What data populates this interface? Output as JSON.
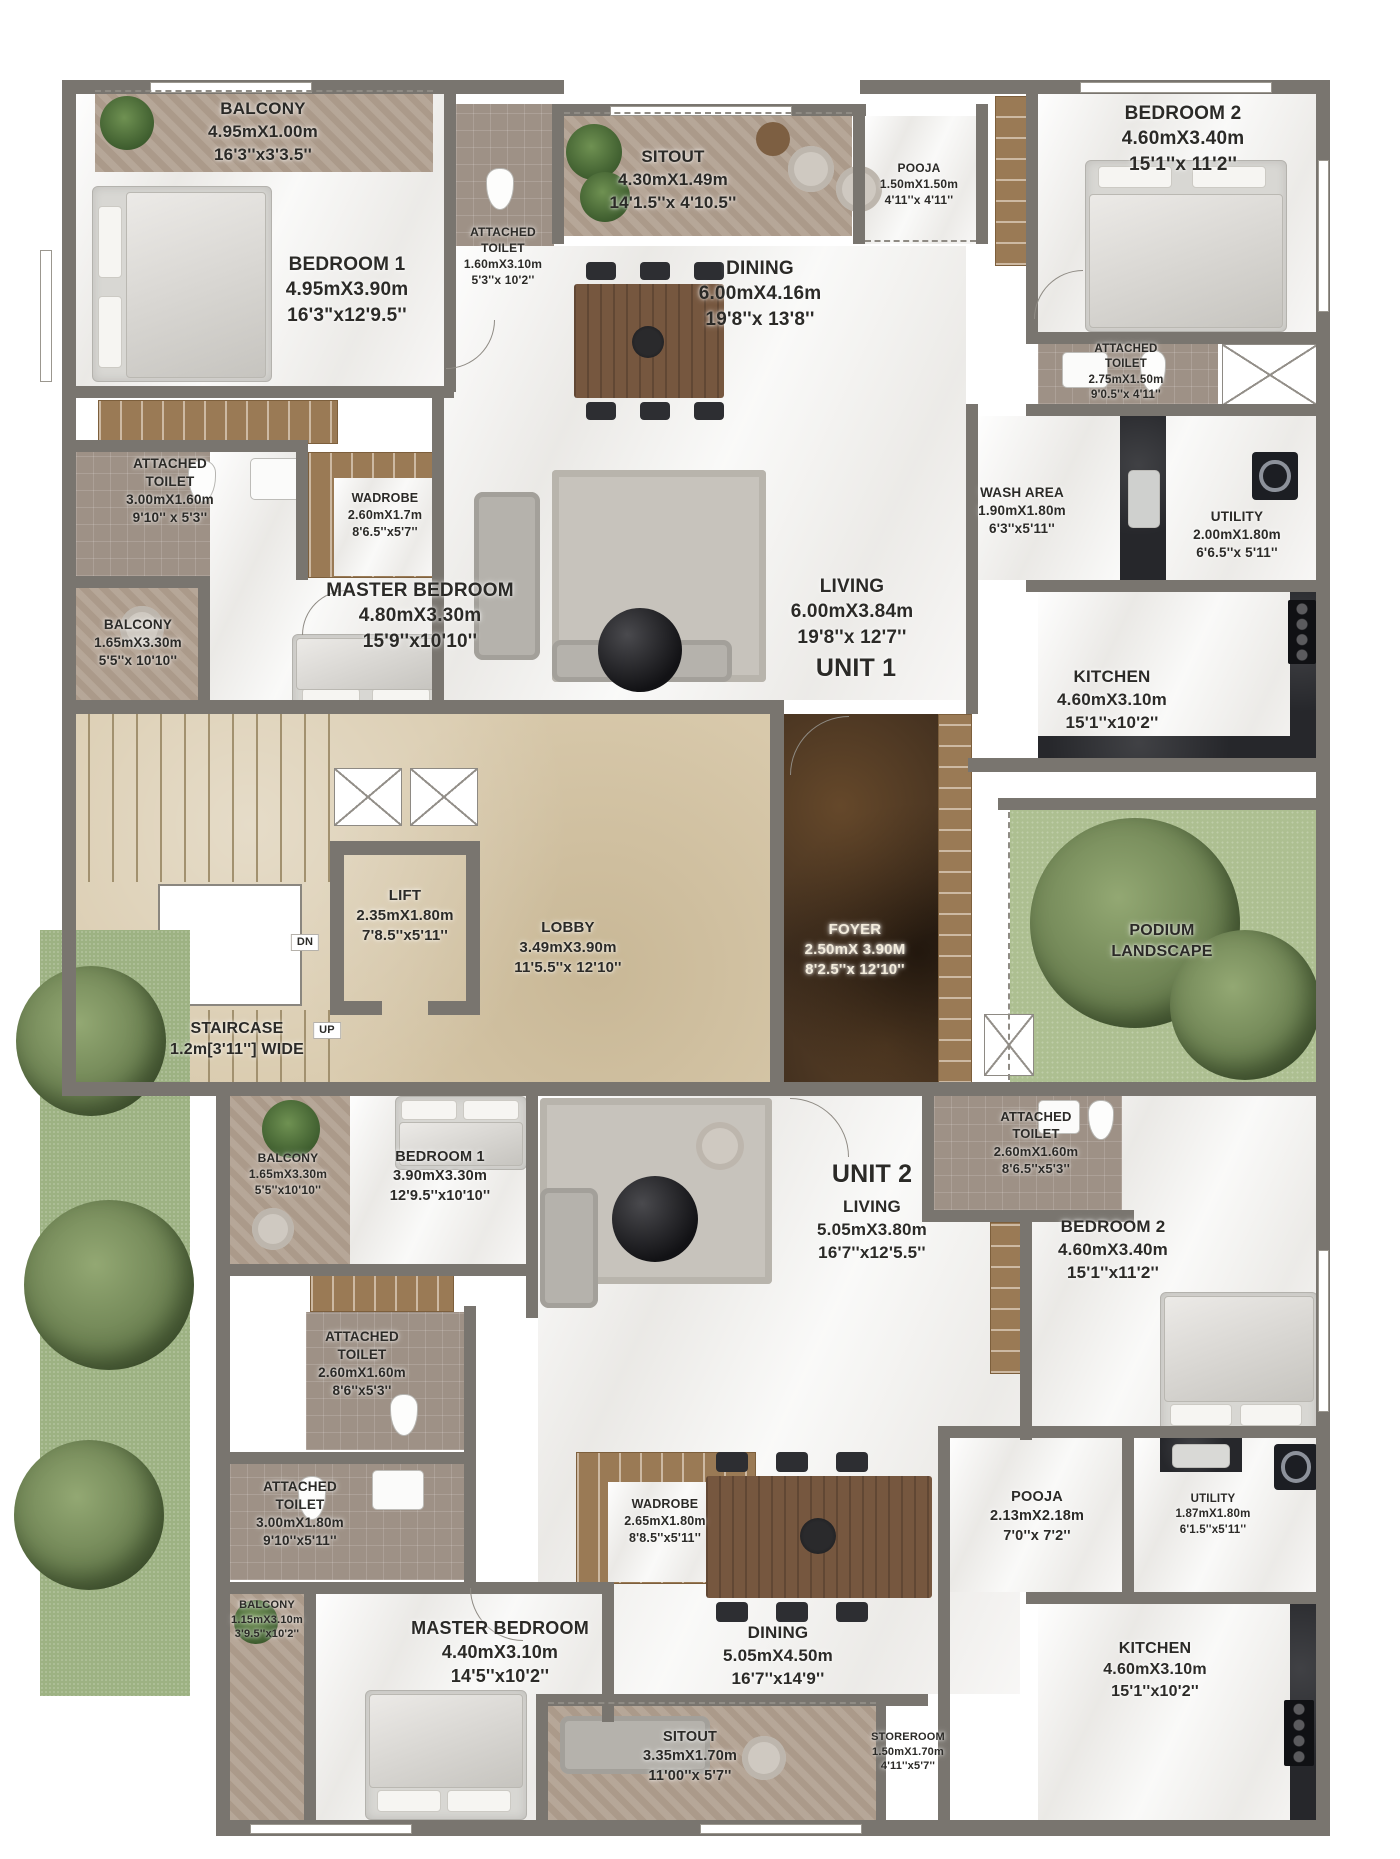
{
  "plan": {
    "type": "residential floor plan",
    "units": [
      "UNIT 1",
      "UNIT 2"
    ],
    "colors": {
      "wall": "#79756f",
      "balcony_floor": "#b1a090",
      "lobby_marble": "#d8c9ab",
      "foyer_marble": "#3e2d1e",
      "podium_green": "#adbf91",
      "wood": "#9a7a55",
      "label_text": "#2b2a27"
    }
  },
  "rooms": [
    {
      "id": "u1-balcony-1",
      "lines": [
        "BALCONY",
        "4.95mX1.00m",
        "16'3''x3'3.5''"
      ],
      "x": 263,
      "y": 98,
      "size": 17
    },
    {
      "id": "u1-bedroom-1",
      "lines": [
        "BEDROOM 1",
        "4.95mX3.90m",
        "16'3\"x12'9.5''"
      ],
      "x": 347,
      "y": 252,
      "size": 19
    },
    {
      "id": "u1-toilet-bedroom-1",
      "lines": [
        "ATTACHED",
        "TOILET",
        "1.60mX3.10m",
        "5'3''x 10'2''"
      ],
      "x": 503,
      "y": 224,
      "size": 12
    },
    {
      "id": "u1-sitout",
      "lines": [
        "SITOUT",
        "4.30mX1.49m",
        "14'1.5''x 4'10.5''"
      ],
      "x": 673,
      "y": 146,
      "size": 17
    },
    {
      "id": "u1-pooja",
      "lines": [
        "POOJA",
        "1.50mX1.50m",
        "4'11''x 4'11''"
      ],
      "x": 919,
      "y": 160,
      "size": 12
    },
    {
      "id": "u1-dining",
      "lines": [
        "DINING",
        "6.00mX4.16m",
        "19'8''x 13'8''"
      ],
      "x": 760,
      "y": 256,
      "size": 19
    },
    {
      "id": "u1-bedroom-2",
      "lines": [
        "BEDROOM 2",
        "4.60mX3.40m",
        "15'1''x 11'2''"
      ],
      "x": 1183,
      "y": 101,
      "size": 19
    },
    {
      "id": "u1-toilet-bedroom-2",
      "lines": [
        "ATTACHED",
        "TOILET",
        "2.75mX1.50m",
        "9'0.5''x 4'11''"
      ],
      "x": 1126,
      "y": 342,
      "size": 11.5
    },
    {
      "id": "u1-toilet-master",
      "lines": [
        "ATTACHED",
        "TOILET",
        "3.00mX1.60m",
        "9'10'' x 5'3''"
      ],
      "x": 170,
      "y": 455,
      "size": 13.5
    },
    {
      "id": "u1-wadrobe",
      "lines": [
        "WADROBE",
        "2.60mX1.7m",
        "8'6.5''x5'7''"
      ],
      "x": 385,
      "y": 490,
      "size": 12.5
    },
    {
      "id": "u1-master-bedroom",
      "lines": [
        "MASTER BEDROOM",
        "4.80mX3.30m",
        "15'9''x10'10''"
      ],
      "x": 420,
      "y": 578,
      "size": 19
    },
    {
      "id": "u1-balcony-2",
      "lines": [
        "BALCONY",
        "1.65mX3.30m",
        "5'5''x 10'10''"
      ],
      "x": 138,
      "y": 616,
      "size": 13.5
    },
    {
      "id": "u1-living",
      "lines": [
        "LIVING",
        "6.00mX3.84m",
        "19'8''x 12'7''"
      ],
      "x": 852,
      "y": 574,
      "size": 19
    },
    {
      "id": "unit-1",
      "lines": [
        "UNIT 1"
      ],
      "x": 856,
      "y": 652,
      "size": 25,
      "weight": 800
    },
    {
      "id": "u1-wash-area",
      "lines": [
        "WASH AREA",
        "1.90mX1.80m",
        "6'3''x5'11''"
      ],
      "x": 1022,
      "y": 484,
      "size": 13.5
    },
    {
      "id": "u1-utility",
      "lines": [
        "UTILITY",
        "2.00mX1.80m",
        "6'6.5''x 5'11''"
      ],
      "x": 1237,
      "y": 508,
      "size": 13.5
    },
    {
      "id": "u1-kitchen",
      "lines": [
        "KITCHEN",
        "4.60mX3.10m",
        "15'1''x10'2''"
      ],
      "x": 1112,
      "y": 666,
      "size": 17
    },
    {
      "id": "lift",
      "lines": [
        "LIFT",
        "2.35mX1.80m",
        "7'8.5''x5'11''"
      ],
      "x": 405,
      "y": 886,
      "size": 15
    },
    {
      "id": "lobby",
      "lines": [
        "LOBBY",
        "3.49mX3.90m",
        "11'5.5''x 12'10''"
      ],
      "x": 568,
      "y": 918,
      "size": 15
    },
    {
      "id": "foyer",
      "lines": [
        "FOYER",
        "2.50mX 3.90M",
        "8'2.5''x 12'10''"
      ],
      "x": 855,
      "y": 920,
      "size": 15,
      "color": "#f3ecdc"
    },
    {
      "id": "podium-landscape",
      "lines": [
        "PODIUM",
        "LANDSCAPE"
      ],
      "x": 1162,
      "y": 920,
      "size": 16
    },
    {
      "id": "staircase",
      "lines": [
        "STAIRCASE",
        "1.2m[3'11''] WIDE"
      ],
      "x": 237,
      "y": 1018,
      "size": 16
    },
    {
      "id": "up",
      "lines": [
        "UP"
      ],
      "x": 327,
      "y": 1022,
      "size": 11,
      "badge": true
    },
    {
      "id": "dn",
      "lines": [
        "DN"
      ],
      "x": 305,
      "y": 934,
      "size": 11,
      "badge": true
    },
    {
      "id": "u2-balcony-1",
      "lines": [
        "BALCONY",
        "1.65mX3.30m",
        "5'5''x10'10''"
      ],
      "x": 288,
      "y": 1150,
      "size": 12
    },
    {
      "id": "u2-bedroom-1",
      "lines": [
        "BEDROOM 1",
        "3.90mX3.30m",
        "12'9.5''x10'10''"
      ],
      "x": 440,
      "y": 1148,
      "size": 14.5
    },
    {
      "id": "unit-2",
      "lines": [
        "UNIT 2"
      ],
      "x": 872,
      "y": 1158,
      "size": 25,
      "weight": 800
    },
    {
      "id": "u2-living",
      "lines": [
        "LIVING",
        "5.05mX3.80m",
        "16'7''x12'5.5''"
      ],
      "x": 872,
      "y": 1196,
      "size": 17
    },
    {
      "id": "u2-toilet-bedroom-2",
      "lines": [
        "ATTACHED",
        "TOILET",
        "2.60mX1.60m",
        "8'6.5''x5'3''"
      ],
      "x": 1036,
      "y": 1108,
      "size": 13
    },
    {
      "id": "u2-bedroom-2",
      "lines": [
        "BEDROOM 2",
        "4.60mX3.40m",
        "15'1''x11'2''"
      ],
      "x": 1113,
      "y": 1216,
      "size": 17
    },
    {
      "id": "u2-toilet-bedroom-1",
      "lines": [
        "ATTACHED",
        "TOILET",
        "2.60mX1.60m",
        "8'6''x5'3''"
      ],
      "x": 362,
      "y": 1328,
      "size": 13.5
    },
    {
      "id": "u2-toilet-master",
      "lines": [
        "ATTACHED",
        "TOILET",
        "3.00mX1.80m",
        "9'10''x5'11''"
      ],
      "x": 300,
      "y": 1478,
      "size": 13.5
    },
    {
      "id": "u2-wadrobe",
      "lines": [
        "WADROBE",
        "2.65mX1.80m",
        "8'8.5''x5'11''"
      ],
      "x": 665,
      "y": 1496,
      "size": 12.5
    },
    {
      "id": "u2-balcony-2",
      "lines": [
        "BALCONY",
        "1.15mX3.10m",
        "3'9.5''x10'2''"
      ],
      "x": 267,
      "y": 1598,
      "size": 11
    },
    {
      "id": "u2-master-bedroom",
      "lines": [
        "MASTER BEDROOM",
        "4.40mX3.10m",
        "14'5''x10'2''"
      ],
      "x": 500,
      "y": 1616,
      "size": 18
    },
    {
      "id": "u2-pooja",
      "lines": [
        "POOJA",
        "2.13mX2.18m",
        "7'0''x 7'2''"
      ],
      "x": 1037,
      "y": 1488,
      "size": 14.5
    },
    {
      "id": "u2-utility",
      "lines": [
        "UTILITY",
        "1.87mX1.80m",
        "6'1.5''x5'11''"
      ],
      "x": 1213,
      "y": 1492,
      "size": 11.5
    },
    {
      "id": "u2-dining",
      "lines": [
        "DINING",
        "5.05mX4.50m",
        "16'7''x14'9''"
      ],
      "x": 778,
      "y": 1622,
      "size": 17
    },
    {
      "id": "u2-sitout",
      "lines": [
        "SITOUT",
        "3.35mX1.70m",
        "11'00''x 5'7''"
      ],
      "x": 690,
      "y": 1728,
      "size": 14.5
    },
    {
      "id": "u2-storeroom",
      "lines": [
        "STOREROOM",
        "1.50mX1.70m",
        "4'11''x5'7''"
      ],
      "x": 908,
      "y": 1730,
      "size": 11
    },
    {
      "id": "u2-kitchen",
      "lines": [
        "KITCHEN",
        "4.60mX3.10m",
        "15'1''x10'2''"
      ],
      "x": 1155,
      "y": 1638,
      "size": 16
    }
  ]
}
